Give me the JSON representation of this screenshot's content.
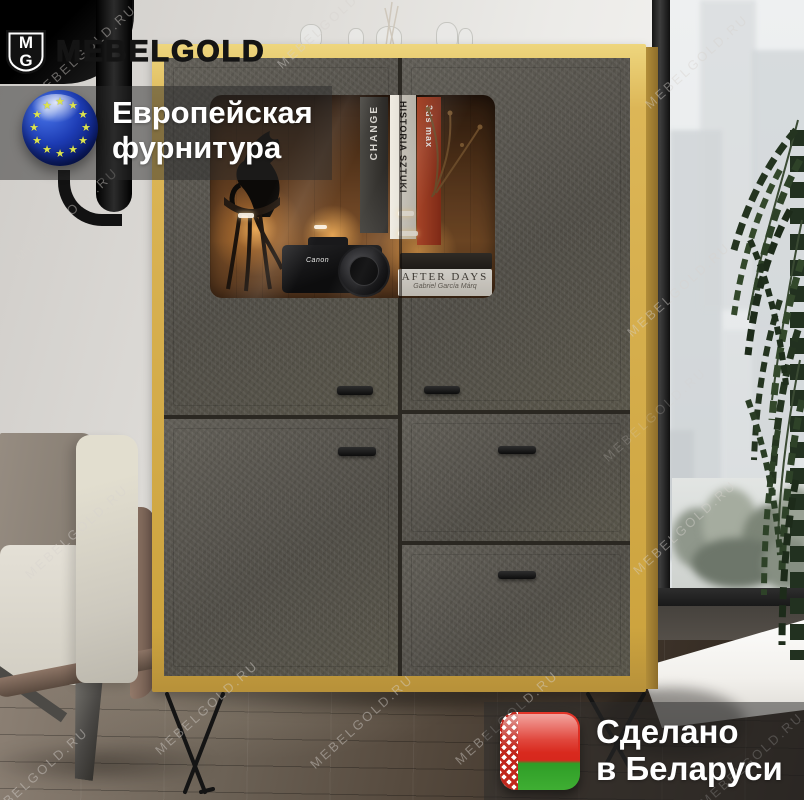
{
  "image": {
    "kind": "furniture product photo",
    "width_px": 804,
    "height_px": 800
  },
  "brand": {
    "name": "MEBELGOLD",
    "logo_monogram_top": "M",
    "logo_monogram_bottom": "G",
    "watermark": "MEBELGOLD.RU"
  },
  "overlays": {
    "eu_badge": {
      "label_line1": "Европейская",
      "label_line2": "фурнитура",
      "icon": "eu-flag-sphere-icon",
      "star_glyph": "★",
      "flag_blue": "#1d3cb4",
      "star_color": "#dde44f"
    },
    "made_in_badge": {
      "label_line1": "Сделано",
      "label_line2": "в Беларуси",
      "icon": "belarus-flag-icon",
      "flag_red": "#d7281d",
      "flag_green": "#3fae33"
    }
  },
  "cabinet_display": {
    "book_spine_1": "CHANGE",
    "book_spine_2": "HISTORIA SZTUKI",
    "book_spine_3": "3ds max",
    "book_cover_title": "AFTER DAYS",
    "book_cover_author": "Gabriel García Márq",
    "camera_brand": "Canon"
  },
  "palette": {
    "oak_frame": "#cda43f",
    "felt_door": "#57544d",
    "overlay_band": "rgba(42,42,42,0.5)",
    "floor_dark": "#2c241d",
    "wall_light": "#ecebe8"
  }
}
